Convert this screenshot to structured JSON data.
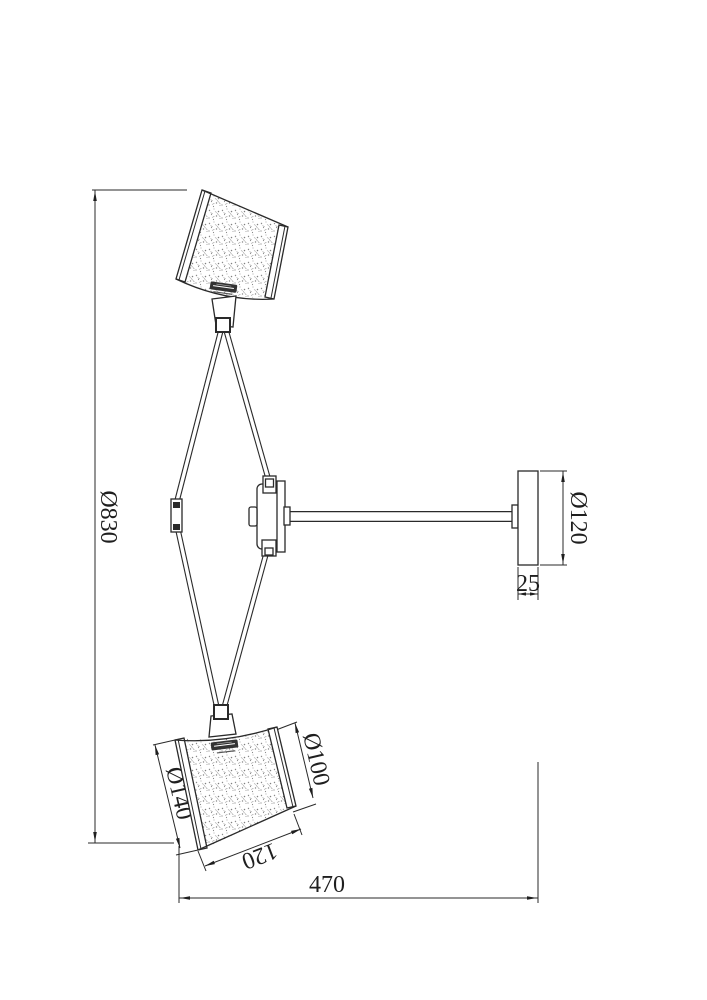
{
  "drawing": {
    "dimensions": {
      "overall_height": "Ø830",
      "canopy_diameter": "Ø120",
      "canopy_depth": "25",
      "shade_large_diameter": "Ø140",
      "shade_small_diameter": "Ø100",
      "shade_height": "120",
      "overall_width": "470"
    },
    "colors": {
      "line": "#2a2a2a",
      "background": "#ffffff",
      "texture_speckle": "#8a8a8a"
    }
  }
}
